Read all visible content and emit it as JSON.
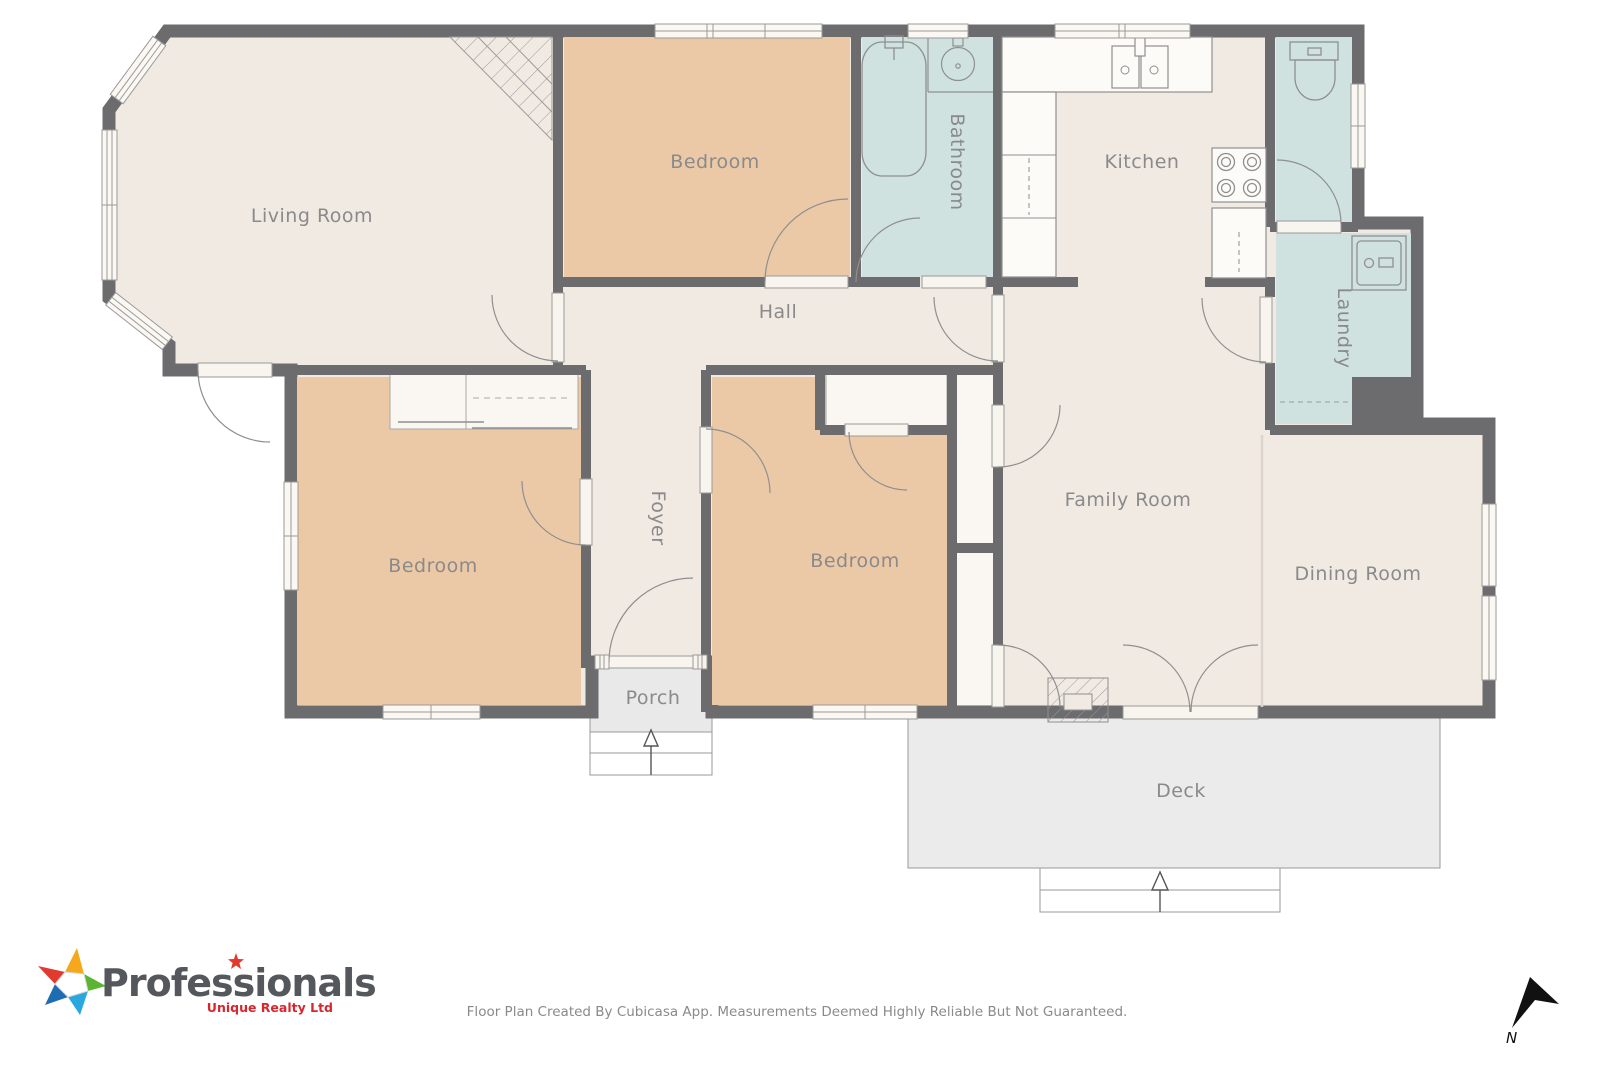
{
  "plan": {
    "rooms": {
      "living_room": "Living Room",
      "bedroom_top": "Bedroom",
      "bathroom": "Bathroom",
      "kitchen": "Kitchen",
      "laundry": "Laundry",
      "hall": "Hall",
      "foyer": "Foyer",
      "bedroom_left": "Bedroom",
      "bedroom_middle": "Bedroom",
      "family_room": "Family Room",
      "dining_room": "Dining Room",
      "porch": "Porch",
      "deck": "Deck"
    },
    "compass": {
      "north_label": "N"
    }
  },
  "branding": {
    "brand": "Professionals",
    "tagline": "Unique Realty Ltd"
  },
  "footer": {
    "disclaimer": "Floor Plan Created By Cubicasa App. Measurements Deemed Highly Reliable But Not Guaranteed."
  },
  "colors": {
    "wall": "#6c6c6e",
    "floor": "#f1eae3",
    "bedroom_fill": "#ecc9a6",
    "wet_room_fill": "#cfe2e0",
    "closet_fill": "#faf7f2",
    "outdoor_fill": "#ebebeb",
    "label": "#8a8a8a",
    "brand_text": "#54585c",
    "brand_red": "#d8262c",
    "star_red": "#e23a2e",
    "star_yellow": "#f5a81c",
    "star_green": "#5cb531",
    "star_lightblue": "#29a8e0",
    "star_darkblue": "#1e6db2"
  }
}
